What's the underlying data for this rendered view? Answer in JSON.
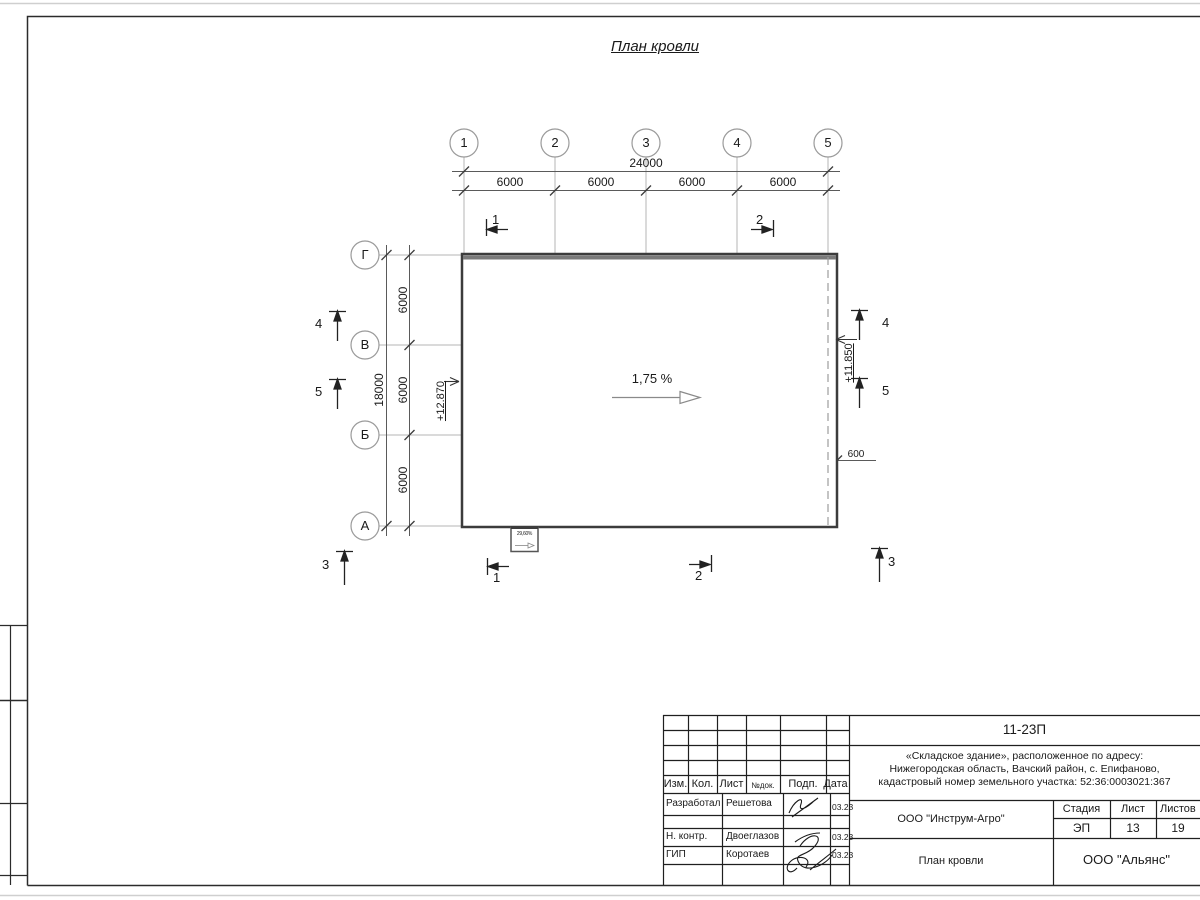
{
  "drawing": {
    "title": "План кровли",
    "slope": {
      "label": "1,75 %"
    },
    "canopy": {
      "slope_label": "29,60%"
    },
    "grid": {
      "top_axes": [
        "1",
        "2",
        "3",
        "4",
        "5"
      ],
      "left_axes": [
        "Г",
        "В",
        "Б",
        "А"
      ]
    },
    "dimensions": {
      "top_total": "24000",
      "top_segments": [
        "6000",
        "6000",
        "6000",
        "6000"
      ],
      "left_total": "18000",
      "left_segments": [
        "6000",
        "6000",
        "6000"
      ],
      "overhang": "600"
    },
    "elevations": {
      "left": "+12.870",
      "right": "+11.850"
    },
    "marks": {
      "section_top_1": "1",
      "section_top_2": "2",
      "section_bottom_1": "1",
      "section_bottom_2": "2",
      "view_bottom_left": "3",
      "view_bottom_right": "3",
      "view_left_4": "4",
      "view_left_5": "5",
      "view_right_4": "4",
      "view_right_5": "5"
    }
  },
  "titleblock": {
    "doc_number": "11-23П",
    "address_lines": [
      "«Складское здание», расположенное по адресу:",
      "Нижегородская область, Вачский район, с. Епифаново,",
      "кадастровый номер земельного участка: 52:36:0003021:367"
    ],
    "columns": {
      "izm": "Изм.",
      "kol": "Кол.",
      "list": "Лист",
      "ndoc": "№док.",
      "podp": "Подп.",
      "data": "Дата"
    },
    "rows": [
      {
        "role": "Разработал",
        "name": "Решетова",
        "date": "03.23"
      },
      {
        "role": "Н. контр.",
        "name": "Двоеглазов",
        "date": "03.23"
      },
      {
        "role": "ГИП",
        "name": "Коротаев",
        "date": "03.23"
      }
    ],
    "org": "ООО \"Инструм-Агро\"",
    "stage_label": "Стадия",
    "stage_value": "ЭП",
    "sheet_label": "Лист",
    "sheet_value": "13",
    "sheets_label": "Листов",
    "sheets_value": "19",
    "sheet_title": "План кровли",
    "company": "ООО \"Альянс\""
  }
}
